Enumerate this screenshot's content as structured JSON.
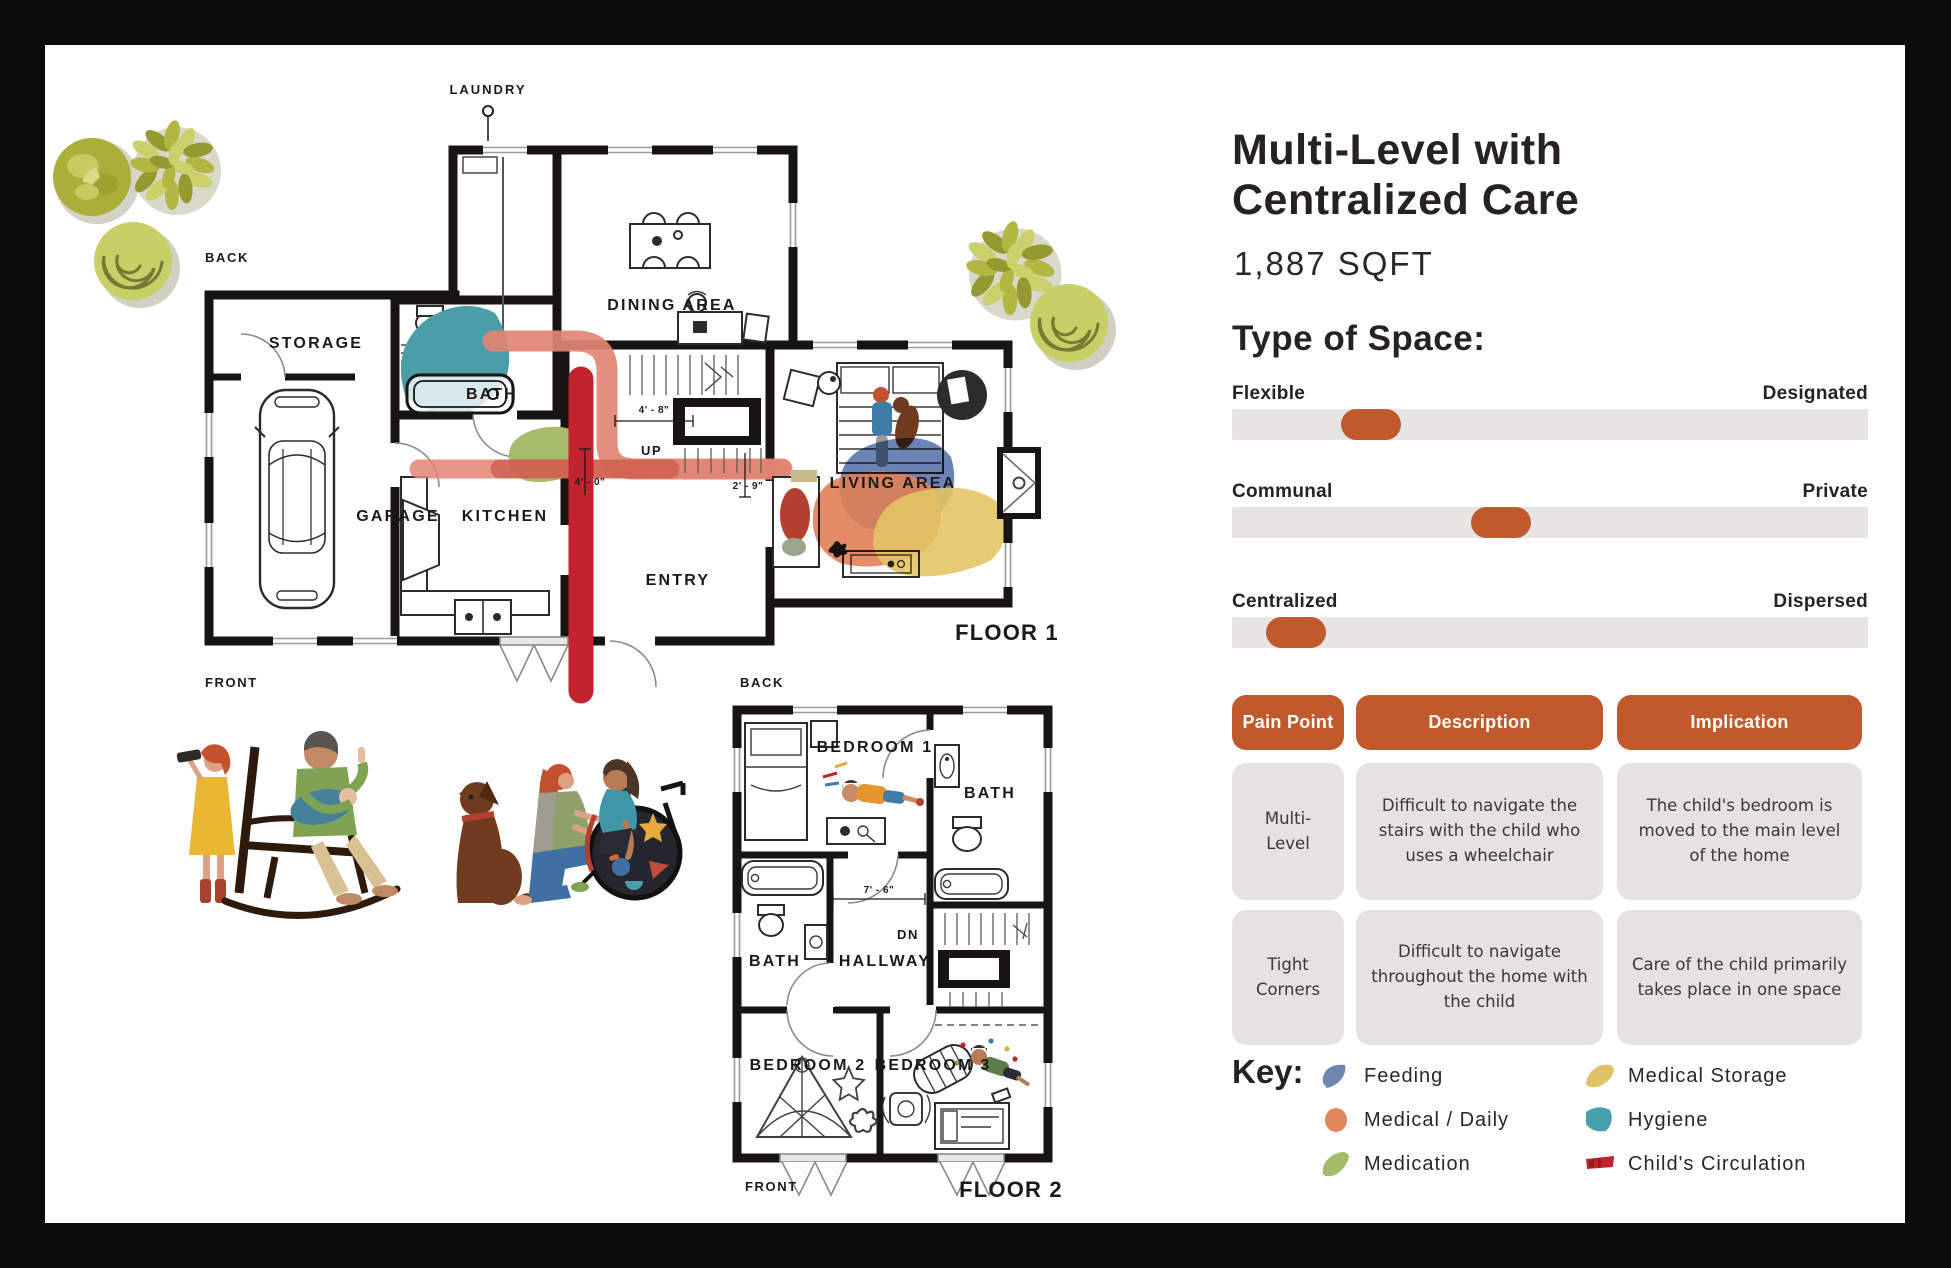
{
  "panel": {
    "title_line1": "Multi-Level with",
    "title_line2": "Centralized Care",
    "sqft": "1,887 SQFT",
    "type_of_space": {
      "heading": "Type of Space:",
      "sliders": [
        {
          "left": "Flexible",
          "right": "Designated",
          "position_pct": 17.2
        },
        {
          "left": "Communal",
          "right": "Private",
          "position_pct": 37.5
        },
        {
          "left": "Centralized",
          "right": "Dispersed",
          "position_pct": 5.4
        }
      ],
      "track_color": "#e6e5e3",
      "handle_color": "#c05a2d"
    },
    "table": {
      "headers": [
        "Pain Point",
        "Description",
        "Implication"
      ],
      "rows": [
        [
          "Multi-Level",
          "Difficult to navigate the stairs with the child who uses a wheelchair",
          "The child's bedroom is moved to the main level of the home"
        ],
        [
          "Tight Corners",
          "Difficult to navigate throughout the home with the child",
          "Care of the child primarily takes place in one space"
        ]
      ],
      "header_color": "#c05a2d",
      "cell_color": "#e4e3e1"
    },
    "key": {
      "heading": "Key:",
      "items": [
        {
          "label": "Feeding",
          "color": "#6f86b1"
        },
        {
          "label": "Medical / Daily",
          "color": "#e2855c"
        },
        {
          "label": "Medication",
          "color": "#a3bc69"
        },
        {
          "label": "Medical Storage",
          "color": "#dfc266"
        },
        {
          "label": "Hygiene",
          "color": "#46a0ac"
        },
        {
          "label": "Child's Circulation",
          "color": "#c1242e"
        }
      ]
    }
  },
  "plan1": {
    "floor": "FLOOR 1",
    "front": "FRONT",
    "back": "BACK",
    "laundry": "LAUNDRY",
    "storage": "STORAGE",
    "garage": "GARAGE",
    "bath": "BATH",
    "kitchen": "KITCHEN",
    "entry": "ENTRY",
    "up": "UP",
    "dining": "DINING AREA",
    "living": "LIVING AREA",
    "dim_a": "4' - 8\"",
    "dim_b": "4' - 0\"",
    "dim_c": "2' - 9\""
  },
  "plan2": {
    "floor": "FLOOR 2",
    "front": "FRONT",
    "back": "BACK",
    "bedroom1": "BEDROOM 1",
    "bedroom2": "BEDROOM 2",
    "bedroom3": "BEDROOM 3",
    "bath_upper": "BATH",
    "bath_lower": "BATH",
    "hallway": "HALLWAY",
    "dn": "DN",
    "dim": "7' - 6\""
  }
}
